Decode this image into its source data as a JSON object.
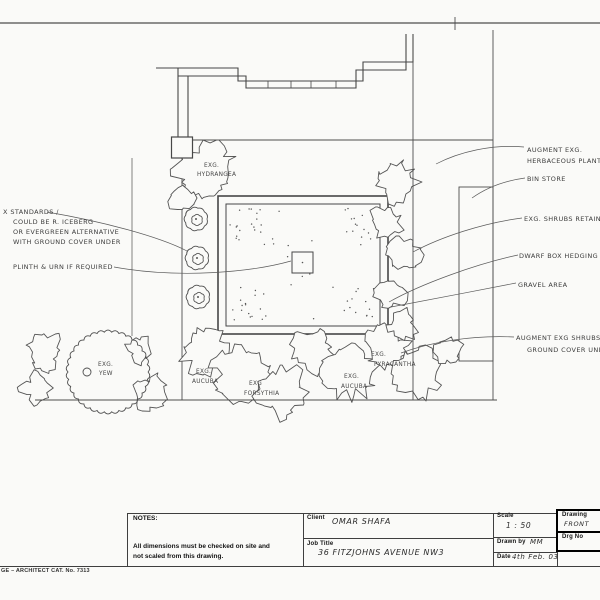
{
  "plan": {
    "annotations": {
      "standards1": "X STANDARDS /",
      "standards2": "COULD BE R. ICEBERG",
      "standards3": "OR EVERGREEN ALTERNATIVE",
      "standards4": "WITH GROUND COVER UNDER",
      "plinth": "PLINTH & URN IF REQUIRED",
      "herbaceous1": "AUGMENT EXG.",
      "herbaceous2": "HERBACEOUS PLANTING",
      "bin_store": "BIN STORE",
      "shrubs_retained": "EXG. SHRUBS RETAINED",
      "dwarf_box": "DWARF BOX HEDGING",
      "gravel": "GRAVEL AREA",
      "augment1": "AUGMENT EXG SHRUBS",
      "augment2": "GROUND COVER UNDER"
    },
    "labels": {
      "hydrangea1": "EXG.",
      "hydrangea2": "HYDRANGEA",
      "yew1": "EXG.",
      "yew2": "YEW",
      "aucuba_a1": "EXG.",
      "aucuba_a2": "AUCUBA",
      "forsythia1": "EXG",
      "forsythia2": "FORSYTHIA",
      "pyracantha1": "EXG.",
      "pyracantha2": "PYRACANTHA",
      "aucuba_b1": "EXG.",
      "aucuba_b2": "AUCUBA"
    }
  },
  "title_block": {
    "notes_label": "NOTES:",
    "notes_line1": "All dimensions must be checked on site and",
    "notes_line2": "not scaled from this drawing.",
    "client_label": "Client",
    "client_value": "OMAR SHAFA",
    "job_title_label": "Job Title",
    "job_title_value": "36 FITZJOHNS AVENUE NW3",
    "scale_label": "Scale",
    "scale_value": "1 : 50",
    "drawn_by_label": "Drawn by",
    "drawn_by_value": "MM",
    "date_label": "Date",
    "date_value": "4th Feb. 03",
    "drawing_label": "Drawing",
    "drawing_value": "FRONT",
    "drg_no_label": "Drg No",
    "catalog_text": "GE – ARCHITECT CAT. No. 7313"
  }
}
